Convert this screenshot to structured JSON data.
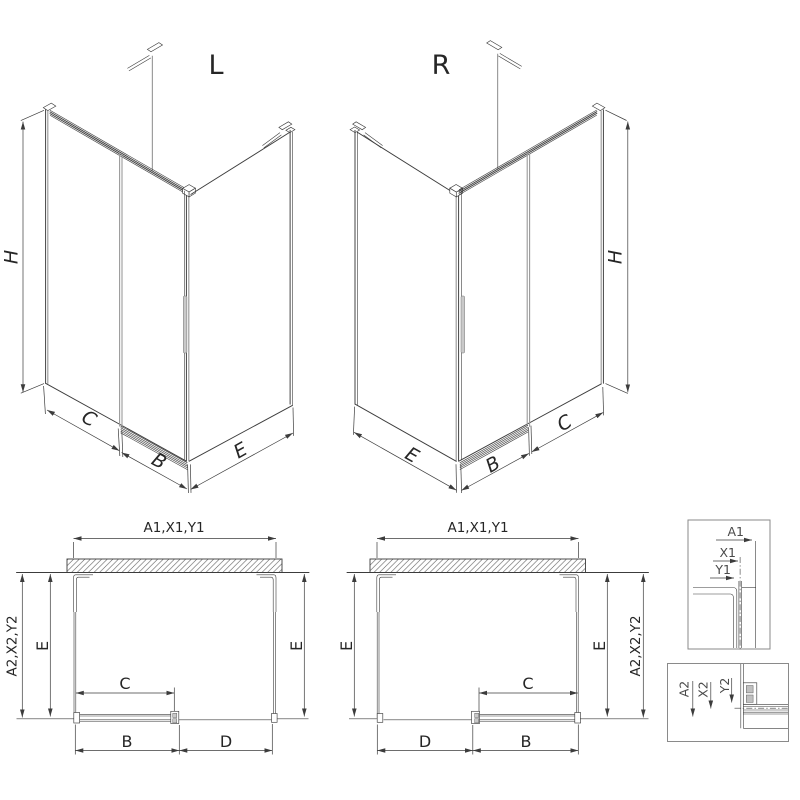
{
  "views": {
    "iso_left": {
      "label": "L",
      "dim_h": "H",
      "dim_c": "C",
      "dim_b": "B",
      "dim_e": "E"
    },
    "iso_right": {
      "label": "R",
      "dim_h": "H",
      "dim_c": "C",
      "dim_b": "B",
      "dim_e": "E"
    },
    "plan_left": {
      "dim_width_top": "A1,X1,Y1",
      "dim_depth_outer": "A2,X2,Y2",
      "dim_e_left": "E",
      "dim_e_right": "E",
      "dim_c": "C",
      "dim_b": "B",
      "dim_d": "D"
    },
    "plan_right": {
      "dim_width_top": "A1,X1,Y1",
      "dim_depth_outer": "A2,X2,Y2",
      "dim_e_left": "E",
      "dim_e_right": "E",
      "dim_c": "C",
      "dim_b": "B",
      "dim_d": "D"
    },
    "detail_wall_profile": {
      "dim_a1": "A1",
      "dim_x1": "X1",
      "dim_y1": "Y1"
    },
    "detail_bottom_rail": {
      "dim_a2": "A2",
      "dim_x2": "X2",
      "dim_y2": "Y2"
    }
  },
  "colors": {
    "line": "#3c3c3c",
    "hardware_gray": "#9a9a9a",
    "background": "#ffffff"
  }
}
